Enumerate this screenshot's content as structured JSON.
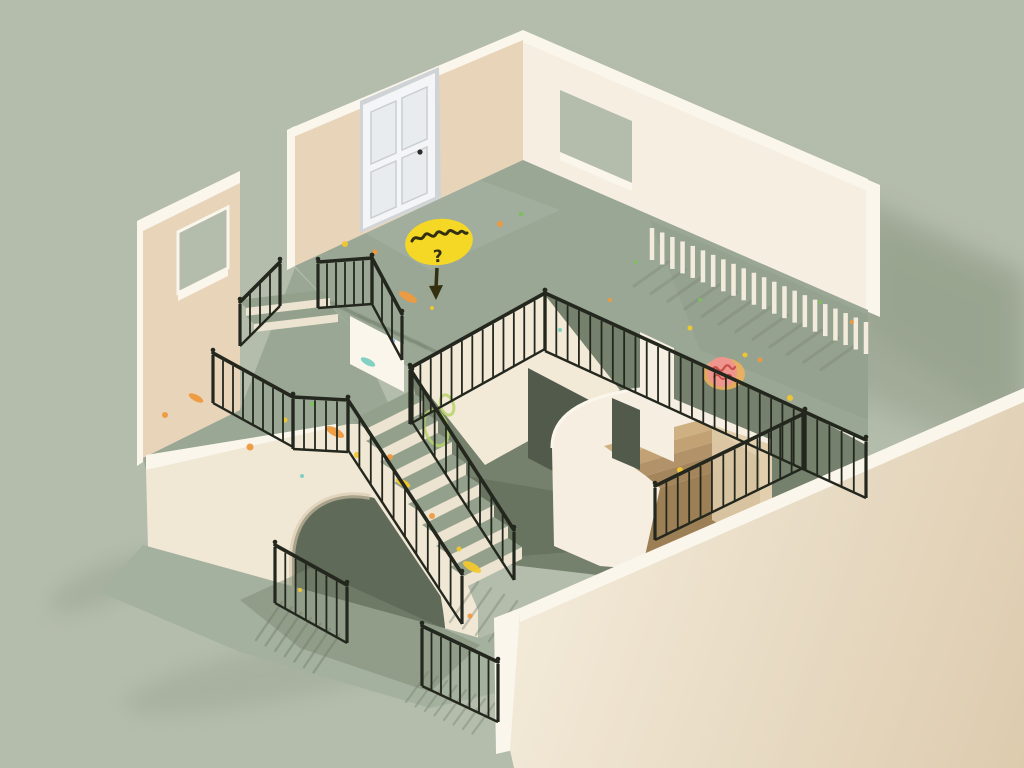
{
  "scene": {
    "background": "#b4bcab"
  },
  "palette": {
    "bg": "#b4bcab",
    "bgShadow": "#8e9a84",
    "floor": "#9aa795",
    "floorLight": "#a4b19f",
    "floorShade": "#7e8a74",
    "wallTan": "#e7d4b9",
    "wallTanShade": "#d9c2a2",
    "wallCream": "#f6efe1",
    "wallBright": "#fbf6ec",
    "slabCream": "#f0e7d4",
    "voidCream": "#f2e9d7",
    "voidDark": "#515a4b",
    "voidFloor": "#75816c",
    "archDark": "#5f6a58",
    "stepTread": "#93a18c",
    "stepRiser": "#ece4d1",
    "nookShade": "#dfcba8",
    "rail": "#23271e",
    "slat": "#f3ecdd",
    "door": "#f3f5f6",
    "doorPanel": "#e9eced",
    "doorEdge": "#c9ced1",
    "doorShadow": "#cfd3d5",
    "knob": "#2b2b28",
    "lowWallTop": "#f2e9d7",
    "lowWallBot": "#ddcbae",
    "bubble": "#f5d826",
    "ink": "#32300f",
    "stickerGlow": "#f4b259",
    "sticker": "#f0958d",
    "stickerInk": "#c9504a",
    "shadowLine": "#6e7a66"
  },
  "callout": {
    "symbol": "?"
  },
  "railings": [
    {
      "name": "door-steps-left",
      "x1": 240,
      "y1": 302,
      "x2": 280,
      "y2": 262,
      "h": 44,
      "n": 5
    },
    {
      "name": "door-landing",
      "x1": 318,
      "y1": 262,
      "x2": 372,
      "y2": 258,
      "h": 46,
      "n": 7
    },
    {
      "name": "door-landing-turn",
      "x1": 372,
      "y1": 258,
      "x2": 402,
      "y2": 314,
      "h": 46,
      "n": 4
    },
    {
      "name": "balcony-front",
      "x1": 213,
      "y1": 353,
      "x2": 293,
      "y2": 397,
      "h": 50,
      "n": 9
    },
    {
      "name": "balcony-link",
      "x1": 293,
      "y1": 397,
      "x2": 348,
      "y2": 400,
      "h": 52,
      "n": 6
    },
    {
      "name": "stair-left",
      "x1": 348,
      "y1": 400,
      "x2": 462,
      "y2": 574,
      "h": 50,
      "n": 11
    },
    {
      "name": "stair-right",
      "x1": 412,
      "y1": 372,
      "x2": 514,
      "y2": 530,
      "h": 50,
      "n": 10
    },
    {
      "name": "void-left",
      "x1": 410,
      "y1": 368,
      "x2": 545,
      "y2": 293,
      "h": 56,
      "n": 14
    },
    {
      "name": "void-right",
      "x1": 545,
      "y1": 293,
      "x2": 805,
      "y2": 412,
      "h": 58,
      "n": 24
    },
    {
      "name": "void-right-end",
      "x1": 805,
      "y1": 412,
      "x2": 866,
      "y2": 440,
      "h": 58,
      "n": 6
    },
    {
      "name": "nook-front",
      "x1": 655,
      "y1": 486,
      "x2": 803,
      "y2": 414,
      "h": 54,
      "n": 14
    },
    {
      "name": "lower-gate-left",
      "x1": 275,
      "y1": 545,
      "x2": 347,
      "y2": 585,
      "h": 58,
      "n": 8
    },
    {
      "name": "lower-gate-front",
      "x1": 422,
      "y1": 626,
      "x2": 498,
      "y2": 662,
      "h": 60,
      "n": 9
    },
    {
      "name": "wall-balustrade",
      "x1": 652,
      "y1": 224,
      "x2": 866,
      "y2": 318,
      "h": 36,
      "n": 22,
      "style": "slat"
    }
  ],
  "stairs": {
    "origin": [
      352,
      420
    ],
    "advance": [
      14,
      9
    ],
    "drop": 12,
    "width": [
      58,
      -29
    ],
    "count": 8
  },
  "nook_steps": [
    {
      "pts": "604,446 700,420 714,429 618,456",
      "c": "#cfb083"
    },
    {
      "pts": "618,456 714,429 728,438 632,466",
      "c": "#c2a274"
    },
    {
      "pts": "632,466 728,438 742,447 646,476",
      "c": "#b29269"
    },
    {
      "pts": "646,476 742,447 760,458 660,488",
      "c": "#a5855c"
    },
    {
      "pts": "660,488 760,458 760,548 645,556",
      "c": "#9c7f55"
    }
  ],
  "confetti": [
    {
      "x": 500,
      "y": 224,
      "t": "dot",
      "c": "#ee9a3e",
      "s": 3
    },
    {
      "x": 521,
      "y": 214,
      "t": "dot",
      "c": "#7fbd63",
      "s": 2.5
    },
    {
      "x": 470,
      "y": 238,
      "t": "dot",
      "c": "#f2c72e",
      "s": 2.5
    },
    {
      "x": 408,
      "y": 297,
      "t": "streak",
      "c": "#ee9a3e",
      "s": 5
    },
    {
      "x": 432,
      "y": 308,
      "t": "dot",
      "c": "#f2c72e",
      "s": 2
    },
    {
      "x": 375,
      "y": 252,
      "t": "dot",
      "c": "#ee9a3e",
      "s": 2.5
    },
    {
      "x": 345,
      "y": 244,
      "t": "dot",
      "c": "#f2c72e",
      "s": 3
    },
    {
      "x": 636,
      "y": 262,
      "t": "dot",
      "c": "#7fbd63",
      "s": 2
    },
    {
      "x": 690,
      "y": 328,
      "t": "dot",
      "c": "#f2c72e",
      "s": 2.5
    },
    {
      "x": 790,
      "y": 398,
      "t": "dot",
      "c": "#f2c72e",
      "s": 3
    },
    {
      "x": 820,
      "y": 302,
      "t": "dot",
      "c": "#7fbd63",
      "s": 2
    },
    {
      "x": 852,
      "y": 322,
      "t": "dot",
      "c": "#ee9a3e",
      "s": 2
    },
    {
      "x": 700,
      "y": 300,
      "t": "dot",
      "c": "#7fbd63",
      "s": 2
    },
    {
      "x": 760,
      "y": 360,
      "t": "dot",
      "c": "#ee9a3e",
      "s": 2.5
    },
    {
      "x": 165,
      "y": 415,
      "t": "dot",
      "c": "#ee9a3e",
      "s": 3
    },
    {
      "x": 196,
      "y": 398,
      "t": "streak",
      "c": "#ee9a3e",
      "s": 4
    },
    {
      "x": 250,
      "y": 447,
      "t": "dot",
      "c": "#ee9a3e",
      "s": 3.5
    },
    {
      "x": 285,
      "y": 420,
      "t": "dot",
      "c": "#f2c72e",
      "s": 2.5
    },
    {
      "x": 312,
      "y": 404,
      "t": "dot",
      "c": "#7fbd63",
      "s": 2.5
    },
    {
      "x": 335,
      "y": 432,
      "t": "streak",
      "c": "#ee9a3e",
      "s": 5
    },
    {
      "x": 357,
      "y": 455,
      "t": "dot",
      "c": "#f2c72e",
      "s": 3
    },
    {
      "x": 302,
      "y": 476,
      "t": "dot",
      "c": "#7ccdc3",
      "s": 2
    },
    {
      "x": 368,
      "y": 362,
      "t": "streak",
      "c": "#7ccdc3",
      "s": 4
    },
    {
      "x": 393,
      "y": 341,
      "t": "dot",
      "c": "#79b1dc",
      "s": 2
    },
    {
      "x": 390,
      "y": 457,
      "t": "dot",
      "c": "#ee9a3e",
      "s": 3
    },
    {
      "x": 403,
      "y": 483,
      "t": "streak",
      "c": "#f2c72e",
      "s": 4
    },
    {
      "x": 432,
      "y": 516,
      "t": "dot",
      "c": "#ee9a3e",
      "s": 3
    },
    {
      "x": 459,
      "y": 549,
      "t": "dot",
      "c": "#f2c72e",
      "s": 2.5
    },
    {
      "x": 472,
      "y": 567,
      "t": "streak",
      "c": "#f2c72e",
      "s": 5
    },
    {
      "x": 300,
      "y": 590,
      "t": "dot",
      "c": "#f2c72e",
      "s": 2
    },
    {
      "x": 470,
      "y": 616,
      "t": "dot",
      "c": "#ee9a3e",
      "s": 2.5
    },
    {
      "x": 680,
      "y": 470,
      "t": "dot",
      "c": "#f2c72e",
      "s": 3
    },
    {
      "x": 560,
      "y": 330,
      "t": "dot",
      "c": "#7ccdc3",
      "s": 2
    },
    {
      "x": 610,
      "y": 300,
      "t": "dot",
      "c": "#ee9a3e",
      "s": 2
    },
    {
      "x": 745,
      "y": 355,
      "t": "dot",
      "c": "#f2c72e",
      "s": 2.5
    },
    {
      "x": 436,
      "y": 428,
      "t": "ring",
      "c": "#b8d26b",
      "s": 14
    },
    {
      "x": 447,
      "y": 405,
      "t": "ring",
      "c": "#b8d26b",
      "s": 8
    }
  ],
  "shadow_fans": [
    {
      "name": "landing-stripes",
      "layer": "upper",
      "x": 318,
      "y": 296,
      "sx": 14,
      "sy": 6.5,
      "dx": 52,
      "dy": 26,
      "n": 8,
      "w": 3.5,
      "op": 0.18
    },
    {
      "name": "balcony-slat-stripes",
      "layer": "upper",
      "x": 668,
      "y": 262,
      "sx": 17,
      "sy": 7.6,
      "dx": -34,
      "dy": 24,
      "n": 12,
      "w": 3.2,
      "op": 0.25
    },
    {
      "name": "gate-left-shadow",
      "layer": "lower",
      "x": 282,
      "y": 602,
      "sx": 9.6,
      "sy": 5.4,
      "dx": -26,
      "dy": 38,
      "n": 7,
      "w": 2.4,
      "op": 0.4
    },
    {
      "name": "stair-bottom-shadow",
      "layer": "lower",
      "x": 478,
      "y": 582,
      "sx": 13,
      "sy": 6.4,
      "dx": -28,
      "dy": 40,
      "n": 8,
      "w": 2.4,
      "op": 0.35
    },
    {
      "name": "gate-front-shadow",
      "layer": "lower",
      "x": 428,
      "y": 672,
      "sx": 9.5,
      "sy": 4.5,
      "dx": -22,
      "dy": 30,
      "n": 8,
      "w": 2.2,
      "op": 0.35
    }
  ]
}
